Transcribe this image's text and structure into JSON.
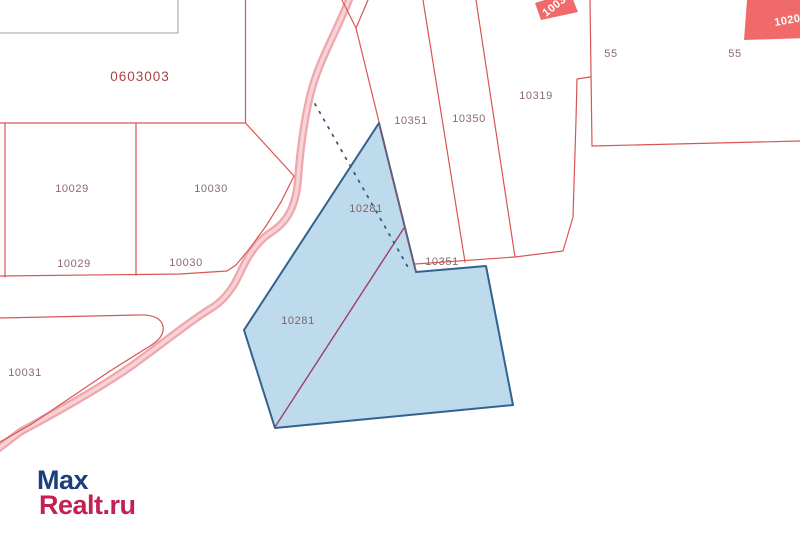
{
  "map": {
    "quarter_label": "0603003",
    "selected_parcel_id": "10281",
    "labels": [
      {
        "text": "0603003",
        "x": 140,
        "y": 81,
        "kind": "big"
      },
      {
        "text": "10029",
        "x": 72,
        "y": 192,
        "kind": ""
      },
      {
        "text": "10030",
        "x": 211,
        "y": 192,
        "kind": ""
      },
      {
        "text": "10029",
        "x": 74,
        "y": 267,
        "kind": ""
      },
      {
        "text": "10030",
        "x": 186,
        "y": 266,
        "kind": ""
      },
      {
        "text": "10031",
        "x": 25,
        "y": 376,
        "kind": ""
      },
      {
        "text": "10351",
        "x": 411,
        "y": 124,
        "kind": ""
      },
      {
        "text": "10350",
        "x": 469,
        "y": 122,
        "kind": ""
      },
      {
        "text": "10319",
        "x": 536,
        "y": 99,
        "kind": ""
      },
      {
        "text": "10351",
        "x": 442,
        "y": 265,
        "kind": ""
      },
      {
        "text": "10281",
        "x": 366,
        "y": 212,
        "kind": "onblue"
      },
      {
        "text": "10281",
        "x": 298,
        "y": 324,
        "kind": "onblue"
      },
      {
        "text": "55",
        "x": 611,
        "y": 57,
        "kind": ""
      },
      {
        "text": "55",
        "x": 735,
        "y": 57,
        "kind": ""
      }
    ],
    "badges": [
      {
        "text": "1003"
      },
      {
        "text": "1020"
      }
    ],
    "colors": {
      "parcel_line": "#d95555",
      "selected_fill": "#b5d6ea",
      "selected_stroke": "#33628e",
      "road": "#eea7ae",
      "label": "#8d6a6a",
      "quarter_label_color": "#a84444",
      "badge_fill": "#f16a6a",
      "logo_blue": "#1b3f7a",
      "logo_red": "#c42053"
    }
  },
  "logo": {
    "line1": "Max",
    "line2": "Realt.ru"
  }
}
